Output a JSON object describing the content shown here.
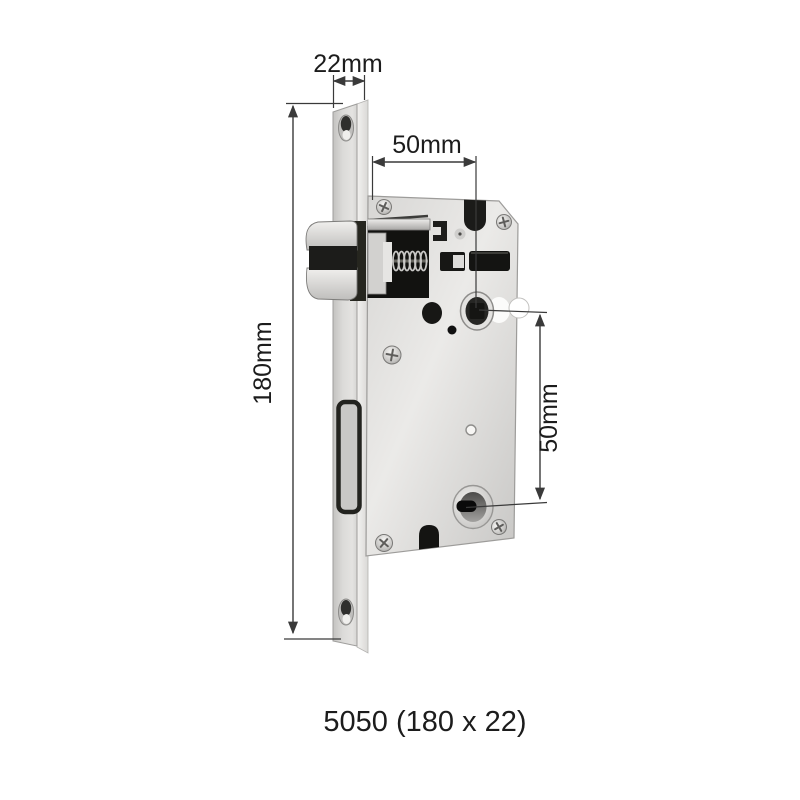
{
  "product": {
    "caption": "5050 (180 x 22)"
  },
  "dimensions": {
    "faceplate_width": "22mm",
    "faceplate_height": "180mm",
    "backset_top": "50mm",
    "center_spacing": "50mm"
  },
  "colors": {
    "background": "#ffffff",
    "dimension_lines": "#3a3a3a",
    "label_text": "#1c1c1c",
    "hardware_black": "#161614",
    "metal_light": "#ecebe9",
    "metal_mid": "#d4d3d1",
    "metal_dark": "#9b9a98"
  }
}
